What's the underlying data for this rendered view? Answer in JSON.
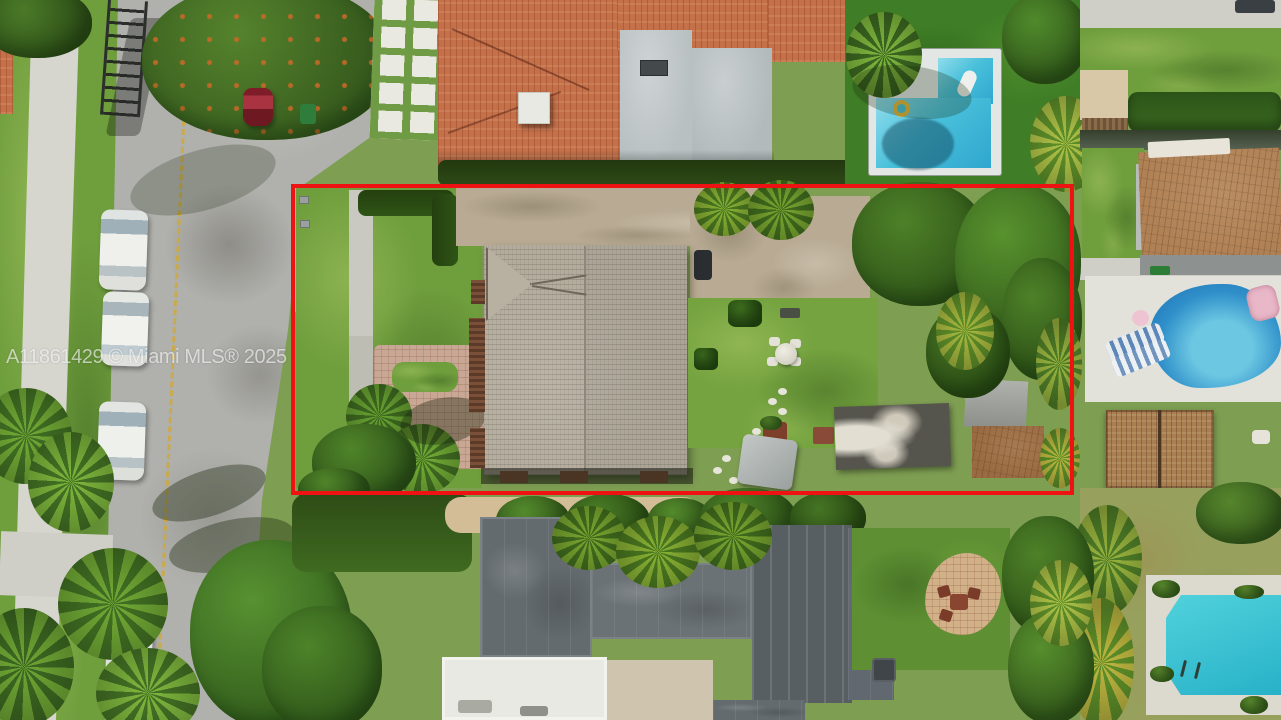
{
  "photo": {
    "kind": "aerial real-estate photograph",
    "watermark_text": "A11861429 © Miami MLS® 2025",
    "boundary": {
      "shape": "rectangle",
      "color": "#ee1212",
      "purpose": "highlighted property lot"
    }
  },
  "colors": {
    "boundary_red": "#ee1212",
    "watermark_white": "rgba(255,255,255,0.62)",
    "street_asphalt": "#b0b0ac",
    "sidewalk_concrete": "#d6d6ce",
    "lawn_green": "#6f9e3d",
    "artificial_turf": "#3f7e26",
    "dry_lawn": "#97a05d",
    "shingle_roof": "#b3ac9d",
    "terracotta_roof": "#c4714a",
    "brown_tile_roof": "#b08155",
    "flat_roof_gray": "#b9c0c2",
    "dark_roof": "#646b6f",
    "pool_water": "#49c0da",
    "paver_driveway": "#c9a795",
    "sand_path": "#d3bd96",
    "center_line_yellow": "#d3a92c"
  }
}
